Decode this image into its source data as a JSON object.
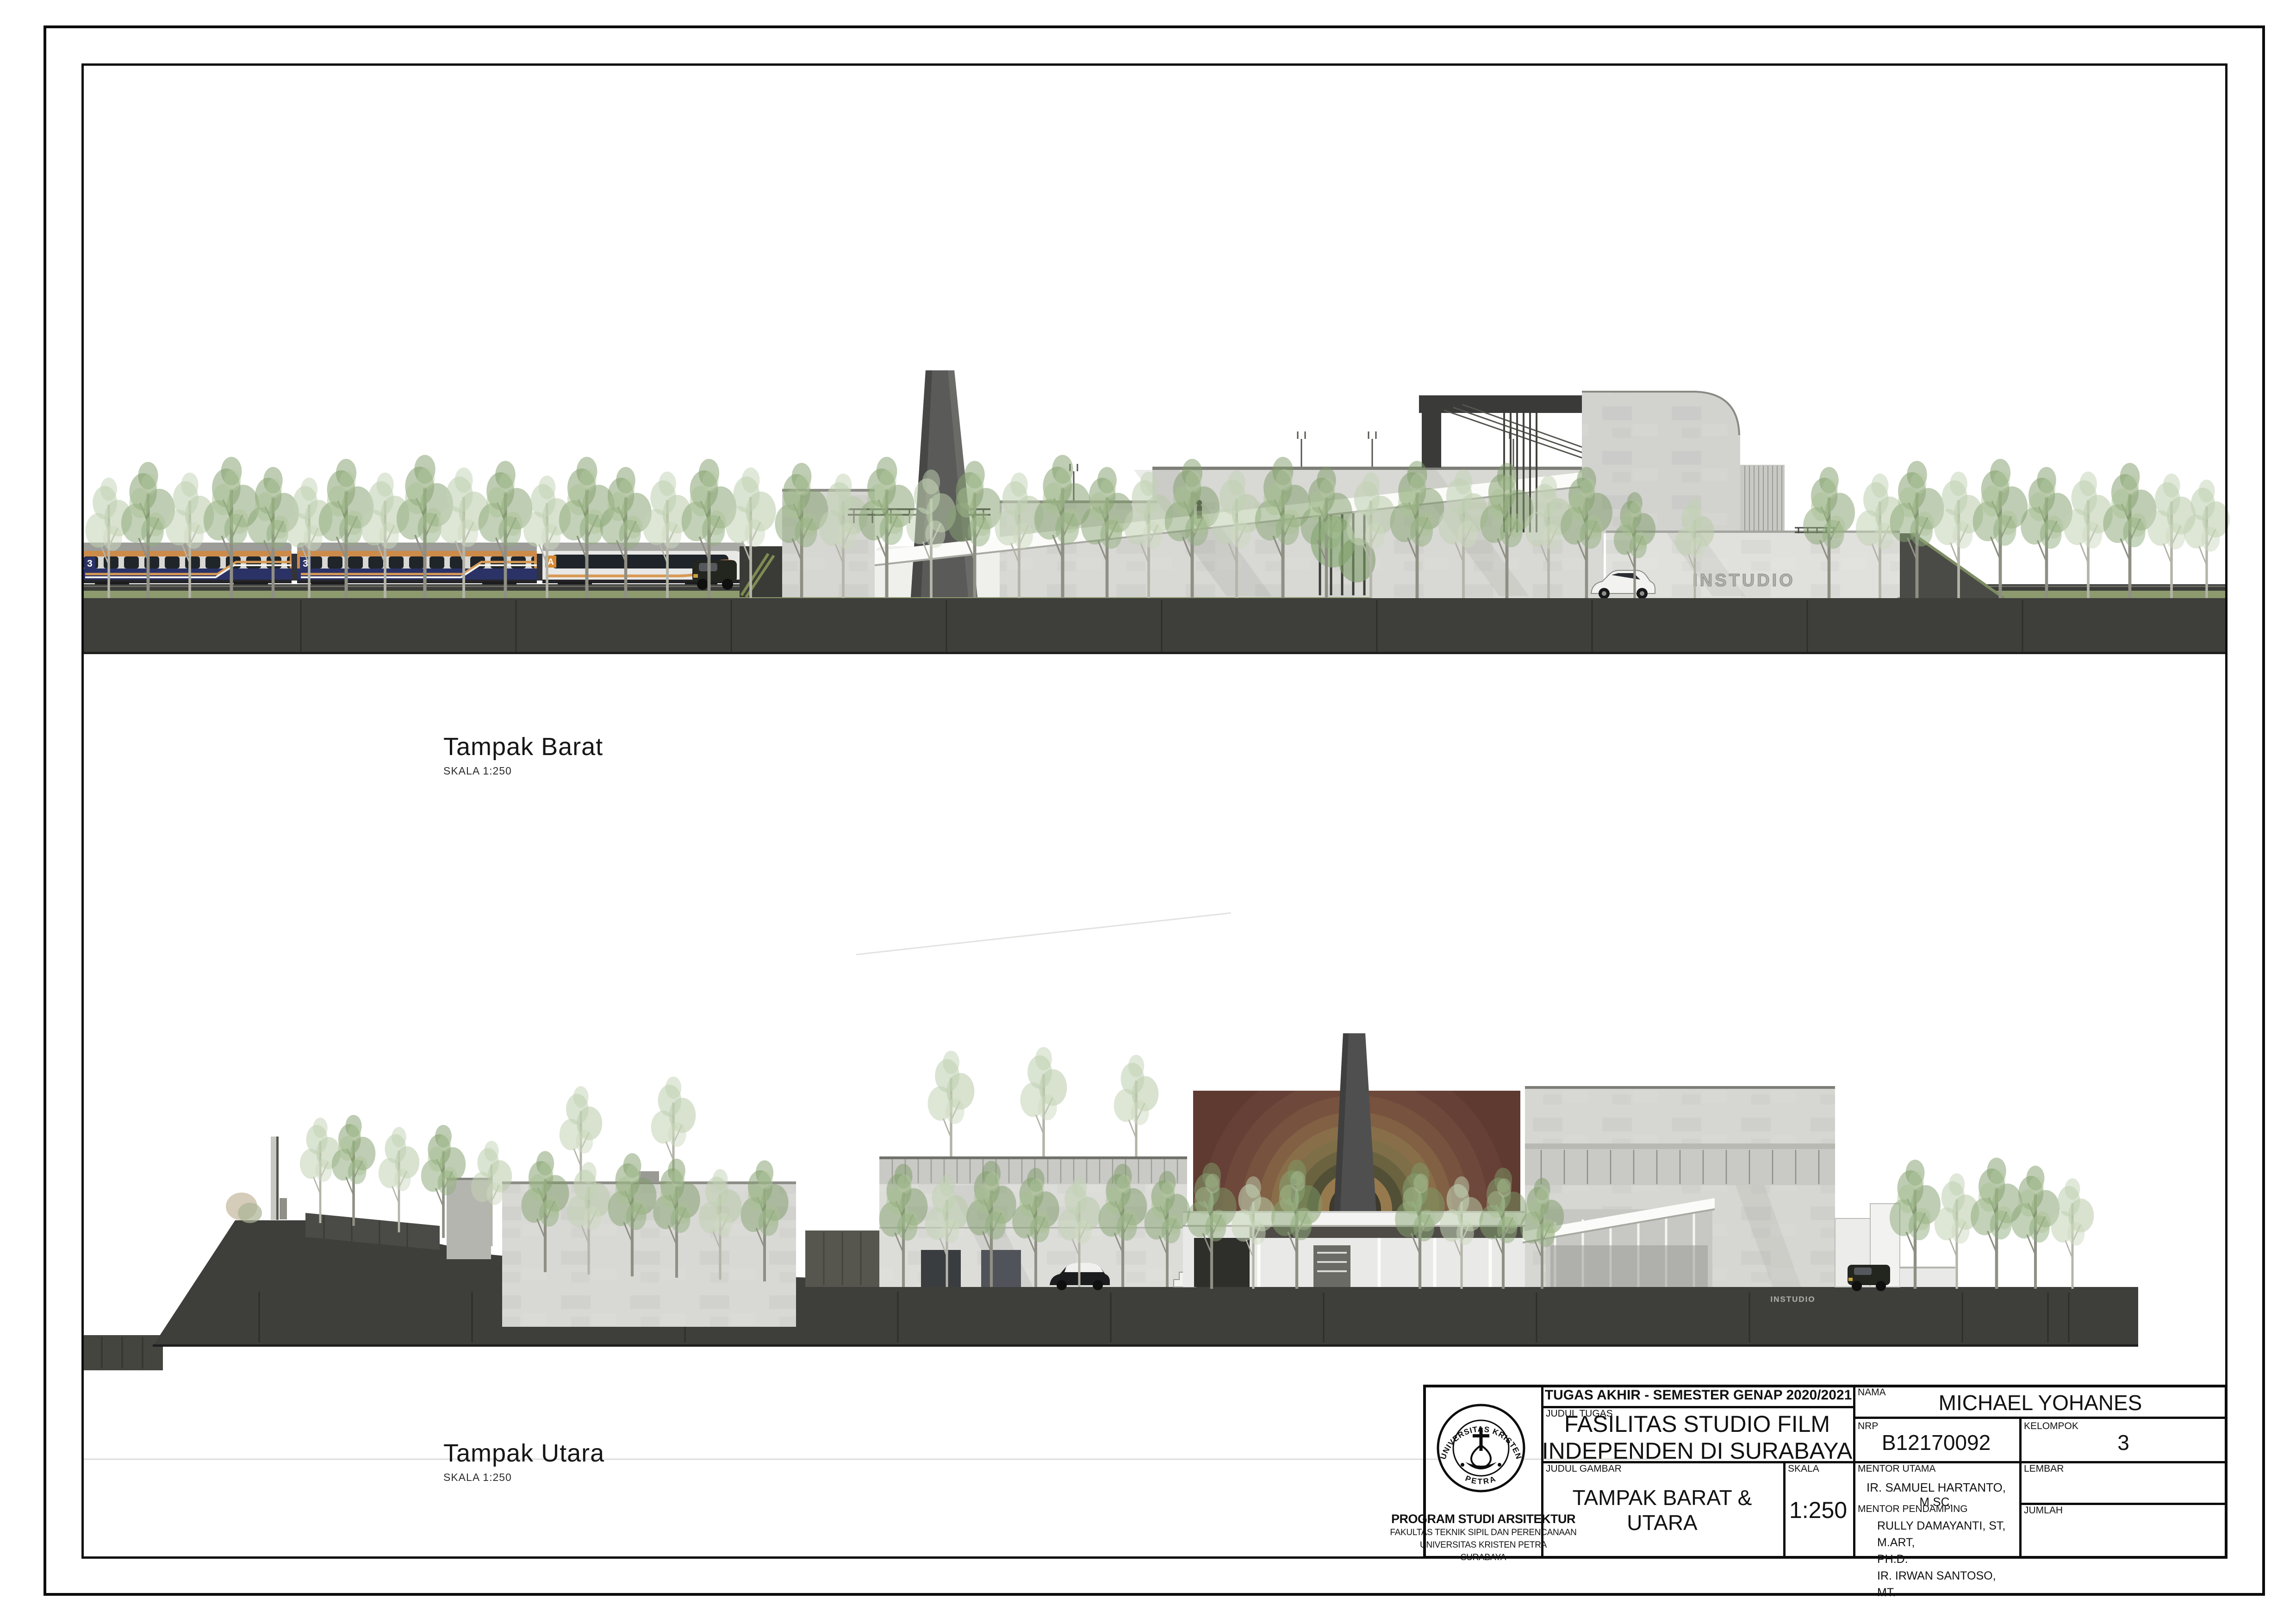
{
  "sheet": {
    "type": "architectural elevation drawing sheet",
    "paper_color": "#ffffff"
  },
  "captions": {
    "west": {
      "title": "Tampak Barat",
      "scale_note": "SKALA 1:250"
    },
    "north": {
      "title": "Tampak Utara",
      "scale_note": "SKALA 1:250"
    }
  },
  "scene": {
    "instudio_sign": "INSTUDIO",
    "instudio_sign_small": "INSTUDIO",
    "coach_class": "3",
    "coach_letter": "A",
    "colors": {
      "ground_dark": "#3e3e3b",
      "concrete": "#d8d8d4",
      "concrete_light": "#e6e6e2",
      "chimney": "#5a5a58",
      "tree_green": "#86a372",
      "tree_pale": "#c2d2b4",
      "grass": "#8c9a6e",
      "train_orange": "#cd8b4a",
      "train_navy": "#2b3266",
      "train_white": "#e8e8e6",
      "screen_maroon": "#5f3a31",
      "screen_gold": "#93784f"
    }
  },
  "title_block": {
    "header": "TUGAS AKHIR - SEMESTER GENAP 2020/2021",
    "judul_tugas_label": "JUDUL TUGAS",
    "judul_tugas_line1": "FASILITAS STUDIO FILM",
    "judul_tugas_line2": "INDEPENDEN DI SURABAYA",
    "judul_gambar_label": "JUDUL GAMBAR",
    "judul_gambar": "TAMPAK BARAT & UTARA",
    "skala_label": "SKALA",
    "skala": "1:250",
    "nama_label": "NAMA",
    "nama": "MICHAEL YOHANES",
    "nrp_label": "NRP",
    "nrp": "B12170092",
    "kelompok_label": "KELOMPOK",
    "kelompok": "3",
    "mentor_utama_label": "MENTOR UTAMA",
    "mentor_utama": "IR. SAMUEL HARTANTO, M.SC.",
    "mentor_pendamping_label": "MENTOR PENDAMPING",
    "mentor_pendamping_line1": "RULLY DAMAYANTI, ST, M.ART,",
    "mentor_pendamping_line2": "PH.D.",
    "mentor_pendamping_line3": "IR. IRWAN SANTOSO, MT.",
    "lembar_label": "LEMBAR",
    "jumlah_label": "JUMLAH",
    "logo": {
      "arc_top": "UNIVERSITAS KRISTEN",
      "arc_bottom": "PETRA"
    },
    "institution": {
      "line1": "PROGRAM STUDI ARSITEKTUR",
      "line2": "FAKULTAS TEKNIK SIPIL DAN PERENCANAAN",
      "line3": "UNIVERSITAS KRISTEN PETRA",
      "line4": "SURABAYA"
    }
  }
}
